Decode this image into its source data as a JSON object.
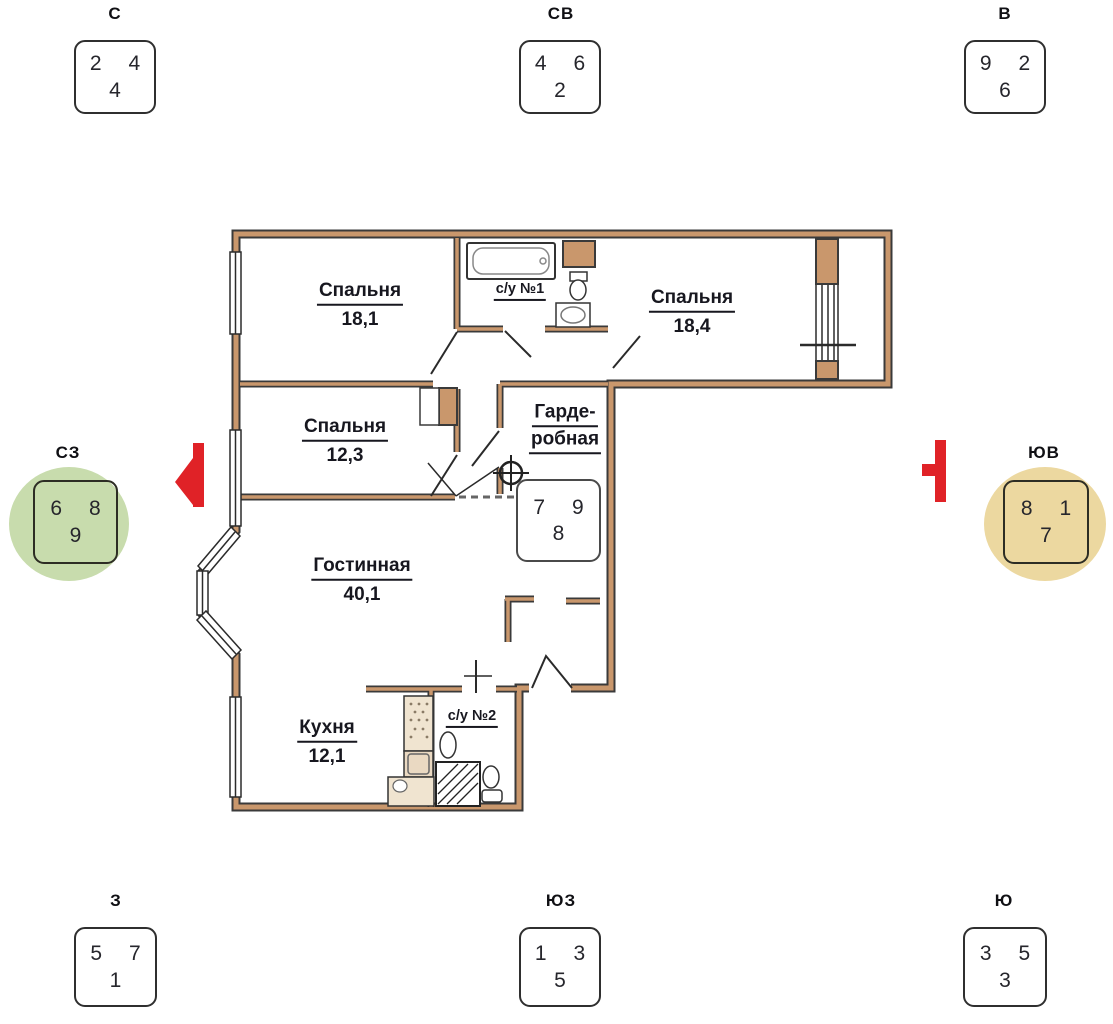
{
  "colors": {
    "marker_red": "#e02227",
    "wall_edge": "#3a3a3a",
    "wall_core": "#c9976c",
    "box_border": "#2f2f2f",
    "digit": "#26262c"
  },
  "compass": {
    "n": {
      "label": "С",
      "numbers": [
        "2",
        "4",
        "4"
      ]
    },
    "ne": {
      "label": "СВ",
      "numbers": [
        "4",
        "6",
        "2"
      ]
    },
    "e": {
      "label": "В",
      "numbers": [
        "9",
        "2",
        "6"
      ]
    },
    "nw": {
      "label": "СЗ",
      "numbers": [
        "6",
        "8",
        "9"
      ],
      "highlight": "#c8dcad"
    },
    "se": {
      "label": "ЮВ",
      "numbers": [
        "8",
        "1",
        "7"
      ],
      "highlight": "#ecd8a0"
    },
    "w": {
      "label": "З",
      "numbers": [
        "5",
        "7",
        "1"
      ]
    },
    "sw": {
      "label": "ЮЗ",
      "numbers": [
        "1",
        "3",
        "5"
      ]
    },
    "s": {
      "label": "Ю",
      "numbers": [
        "3",
        "5",
        "3"
      ]
    }
  },
  "plan_box": {
    "numbers": [
      "7",
      "9",
      "8"
    ]
  },
  "floor_plan": {
    "rooms": {
      "bedroom_top_left": {
        "name": "Спальня",
        "area": "18,1"
      },
      "bathroom_1": {
        "name": "с/у №1"
      },
      "bedroom_top_right": {
        "name": "Спальня",
        "area": "18,4"
      },
      "bedroom_mid": {
        "name": "Спальня",
        "area": "12,3"
      },
      "wardrobe": {
        "name_line1": "Гарде-",
        "name_line2": "робная"
      },
      "living": {
        "name": "Гостинная",
        "area": "40,1"
      },
      "kitchen": {
        "name": "Кухня",
        "area": "12,1"
      },
      "bathroom_2": {
        "name": "с/у №2"
      }
    }
  }
}
